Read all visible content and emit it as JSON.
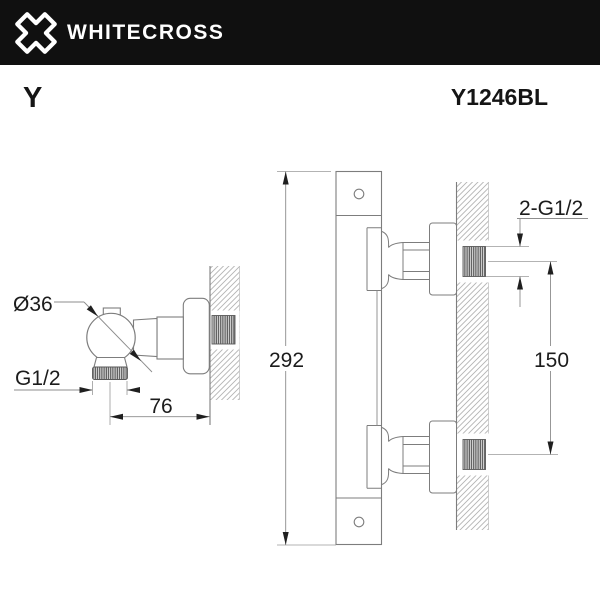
{
  "header": {
    "brand": "WHITECROSS",
    "logo_icon": "whitecross-x-icon"
  },
  "product": {
    "series": "Y",
    "code": "Y1246BL"
  },
  "drawings": {
    "left_view": {
      "description": "side view of wall-mounted shower outlet elbow",
      "labels": {
        "diameter": "Ø36",
        "thread": "G1/2",
        "depth": "76"
      }
    },
    "right_view": {
      "description": "front view of thermostatic shower bar with two wall unions",
      "labels": {
        "height": "292",
        "spacing": "150",
        "connections": "2-G1/2"
      }
    }
  },
  "colors": {
    "header_bg": "#101010",
    "drawing_line": "#7d7d7d",
    "dimension_text": "#1c1c1c"
  }
}
